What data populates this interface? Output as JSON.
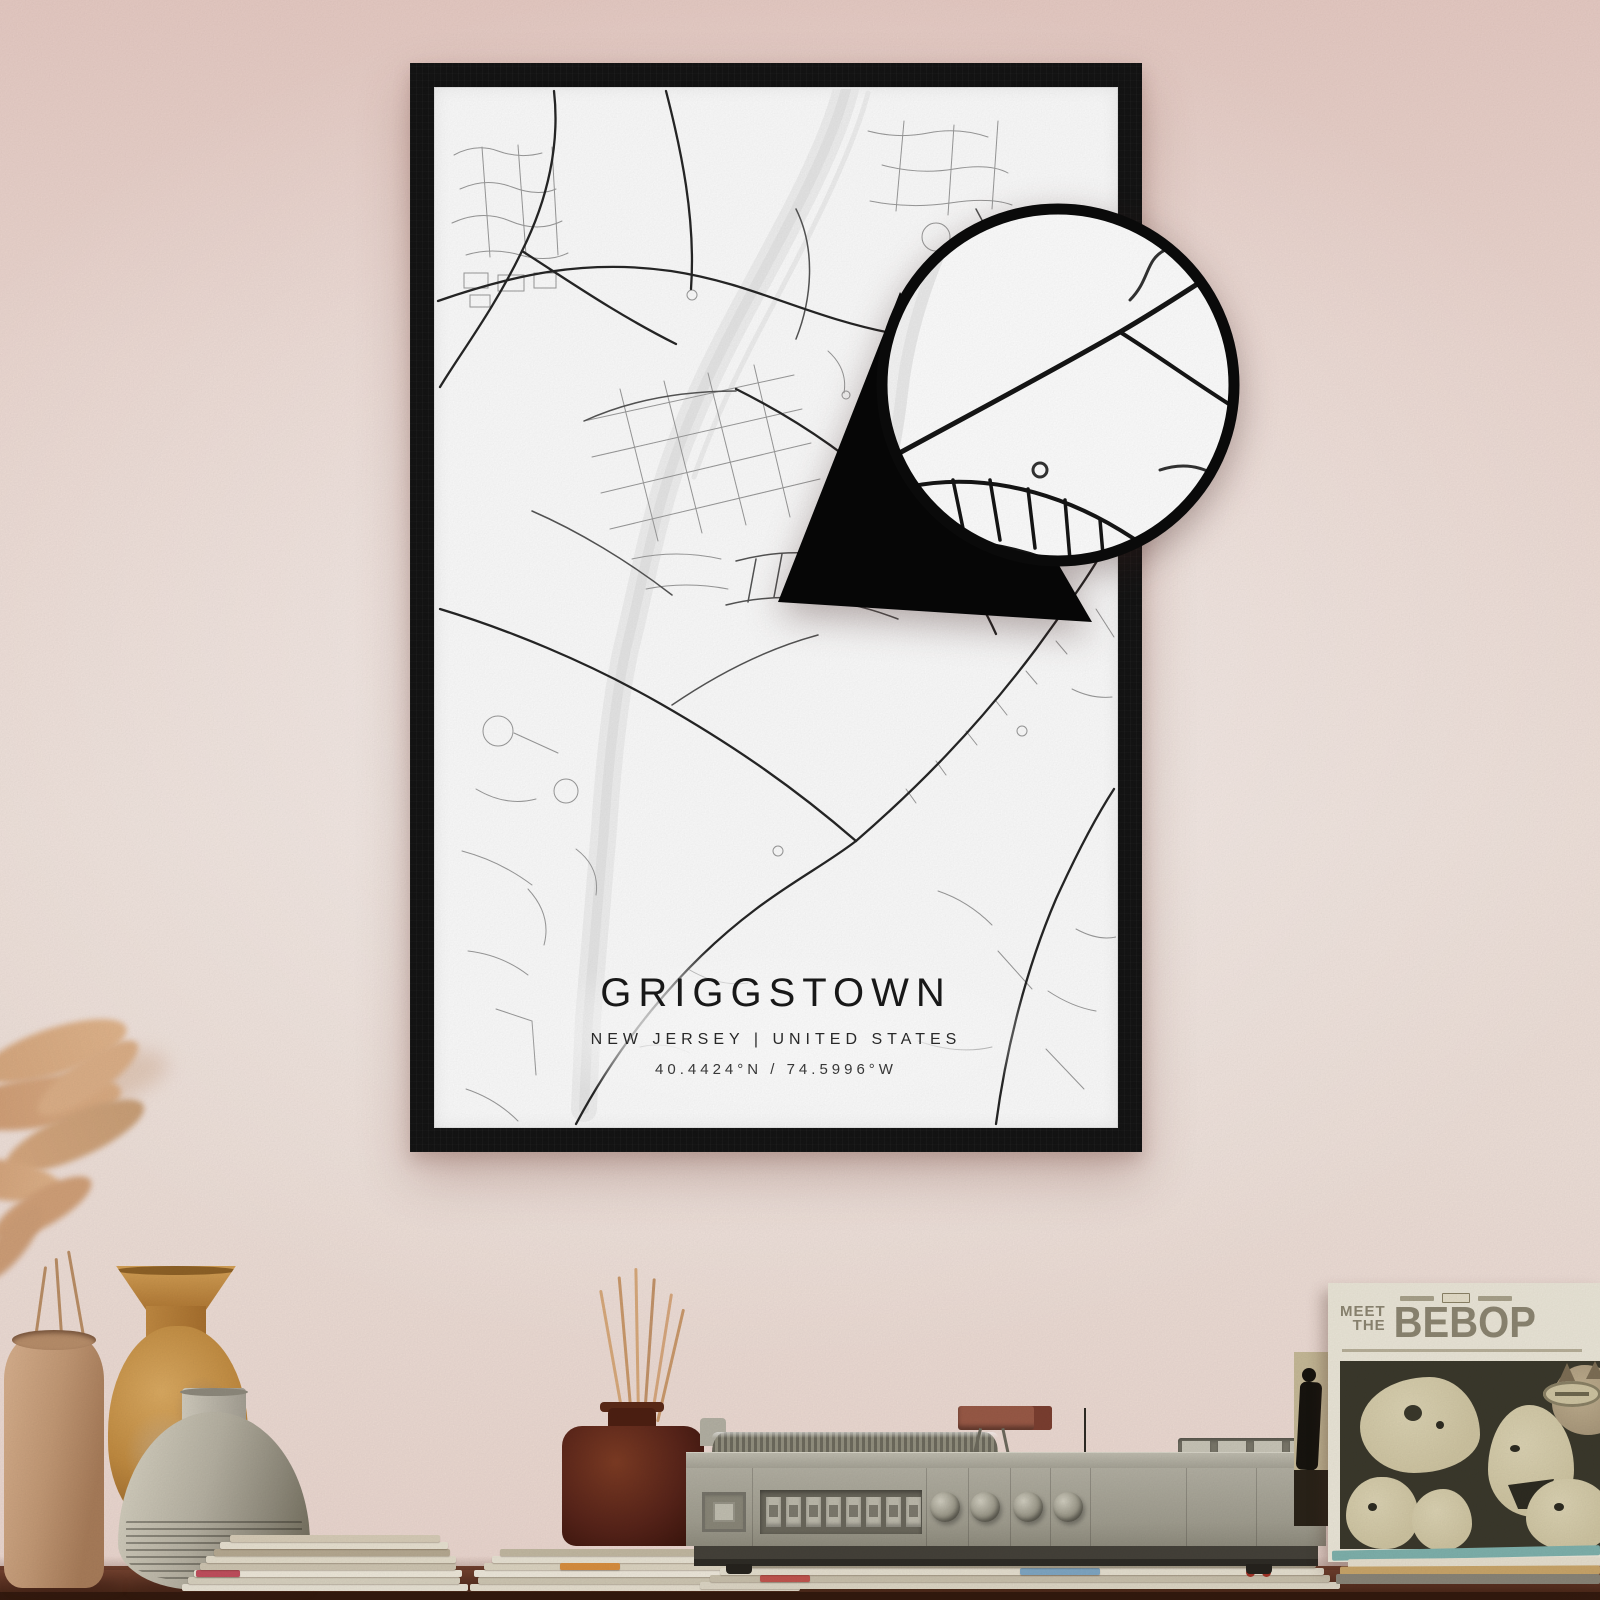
{
  "poster": {
    "title": "GRIGGSTOWN",
    "region_line": "NEW JERSEY | UNITED STATES",
    "coordinates_line": "40.4424°N / 74.5996°W"
  },
  "album": {
    "title_word1": "MEET",
    "title_word2": "THE",
    "title_word3": "BEBOP"
  },
  "colors": {
    "wall-top": "#e8ccc5",
    "wall-mid": "#f1e2db",
    "wall-bottom": "#ecd7cf",
    "frame": "#141414",
    "paper": "#fdfdfd",
    "road-major": "#262626",
    "road-minor": "#9a9a9a",
    "water": "#e9e9e9",
    "table-wood": "#5e3424",
    "turntable-body": "#a8a598",
    "album-ink": "#8d8672",
    "album-art-bg": "#3b392c"
  }
}
